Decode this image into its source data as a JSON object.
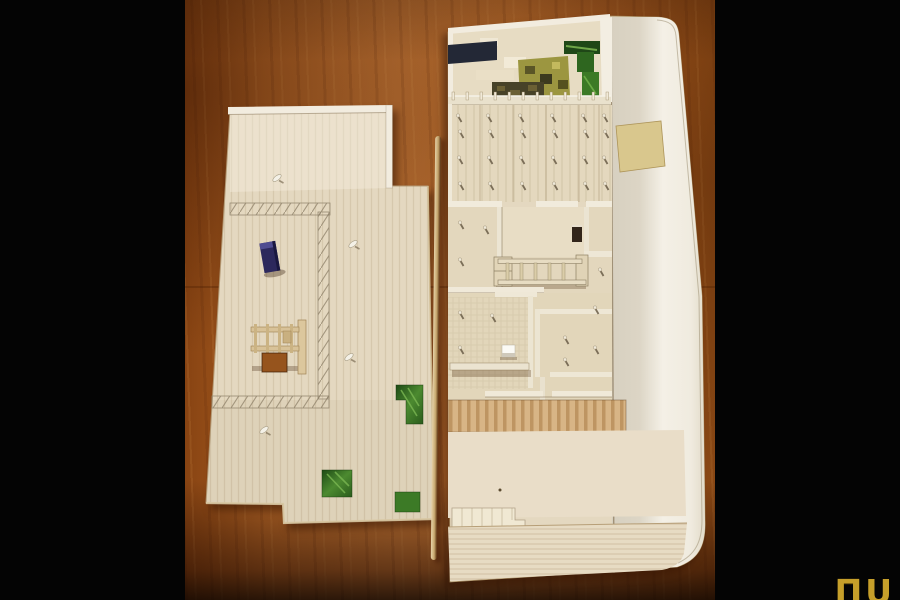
{
  "image": {
    "type": "photograph",
    "subject": "Two balsa-wood architectural scale-model boards (site plan and floor plan with partition walls, columns and a long rounded wall) lying on an orange wooden table, letterboxed with black side bars"
  },
  "watermark": {
    "text": "ΠU"
  },
  "objects": {
    "left_board": "flat site-plan board with pencil hatch markings, blue block, small frame structure, cut-out hole, white pins and green photo inlays",
    "right_board": "floor-plan model with garden collage strip, column hall, partition-wall rooms, shelf piece, white cube, slat deck and long curved edge wall",
    "stick": "thin wooden strip lying in the gap between the two boards",
    "pins_on_left_board": 4,
    "green_inlays_on_left_board": 3
  },
  "palette": {
    "background": "#040404",
    "table_wood": "#c07434",
    "table_wood_dark": "#96541d",
    "balsa": "#e4d8c0",
    "balsa_shadow": "#cbb68e",
    "wall_white": "#f2ecdf",
    "slat_tan": "#d8b586",
    "navy_patch": "#232836",
    "olive_patch": "#9c9640",
    "camo_dark": "#474228",
    "green_dark": "#1f4717",
    "green_mid": "#3c7a26",
    "blue_block": "#2c285c",
    "white_cube": "#fbfaf5",
    "stick_tan": "#c8a96f",
    "logo_gold": "#c69f2a"
  }
}
